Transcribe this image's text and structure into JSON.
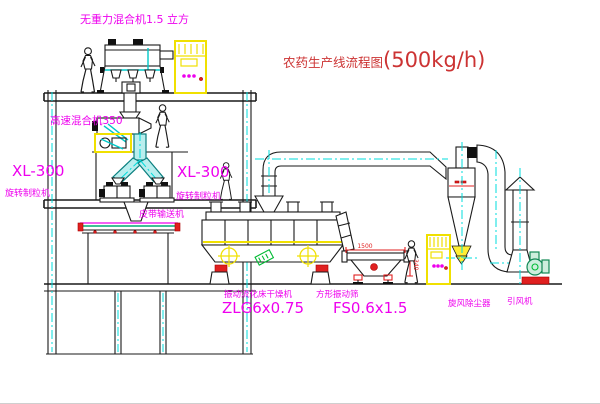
{
  "title": {
    "cn": "农药生产线流程图",
    "rate": "(500kg/h)"
  },
  "labels": {
    "top_mixer": "无重力混合机1.5 立方",
    "floor2_mixer": "高速混合机350",
    "granulator_left_model": "XL-300",
    "granulator_left_name": "旋转制粒机",
    "granulator_right_model": "XL-300",
    "granulator_right_name": "旋转制粒机",
    "belt": "皮带输送机",
    "dryer_name": "振动流化床干燥机",
    "dryer_model": "ZLG6x0.75",
    "sieve_name": "方形振动筛",
    "sieve_model": "FS0.6x1.5",
    "cyclone": "旋风除尘器",
    "fan": "引风机"
  },
  "dimensions": {
    "sieve_length": "1500",
    "sieve_height": "340"
  },
  "colors": {
    "title_red": "#cc3333",
    "label_magenta": "#ee00ee",
    "highlight_yellow": "#f0e000",
    "centerline_cyan": "#00dcdc",
    "pipe_teal": "#b9eeee",
    "equipment_green": "#118855",
    "alert_red": "#e02020",
    "line_black": "#1a1a1a"
  }
}
